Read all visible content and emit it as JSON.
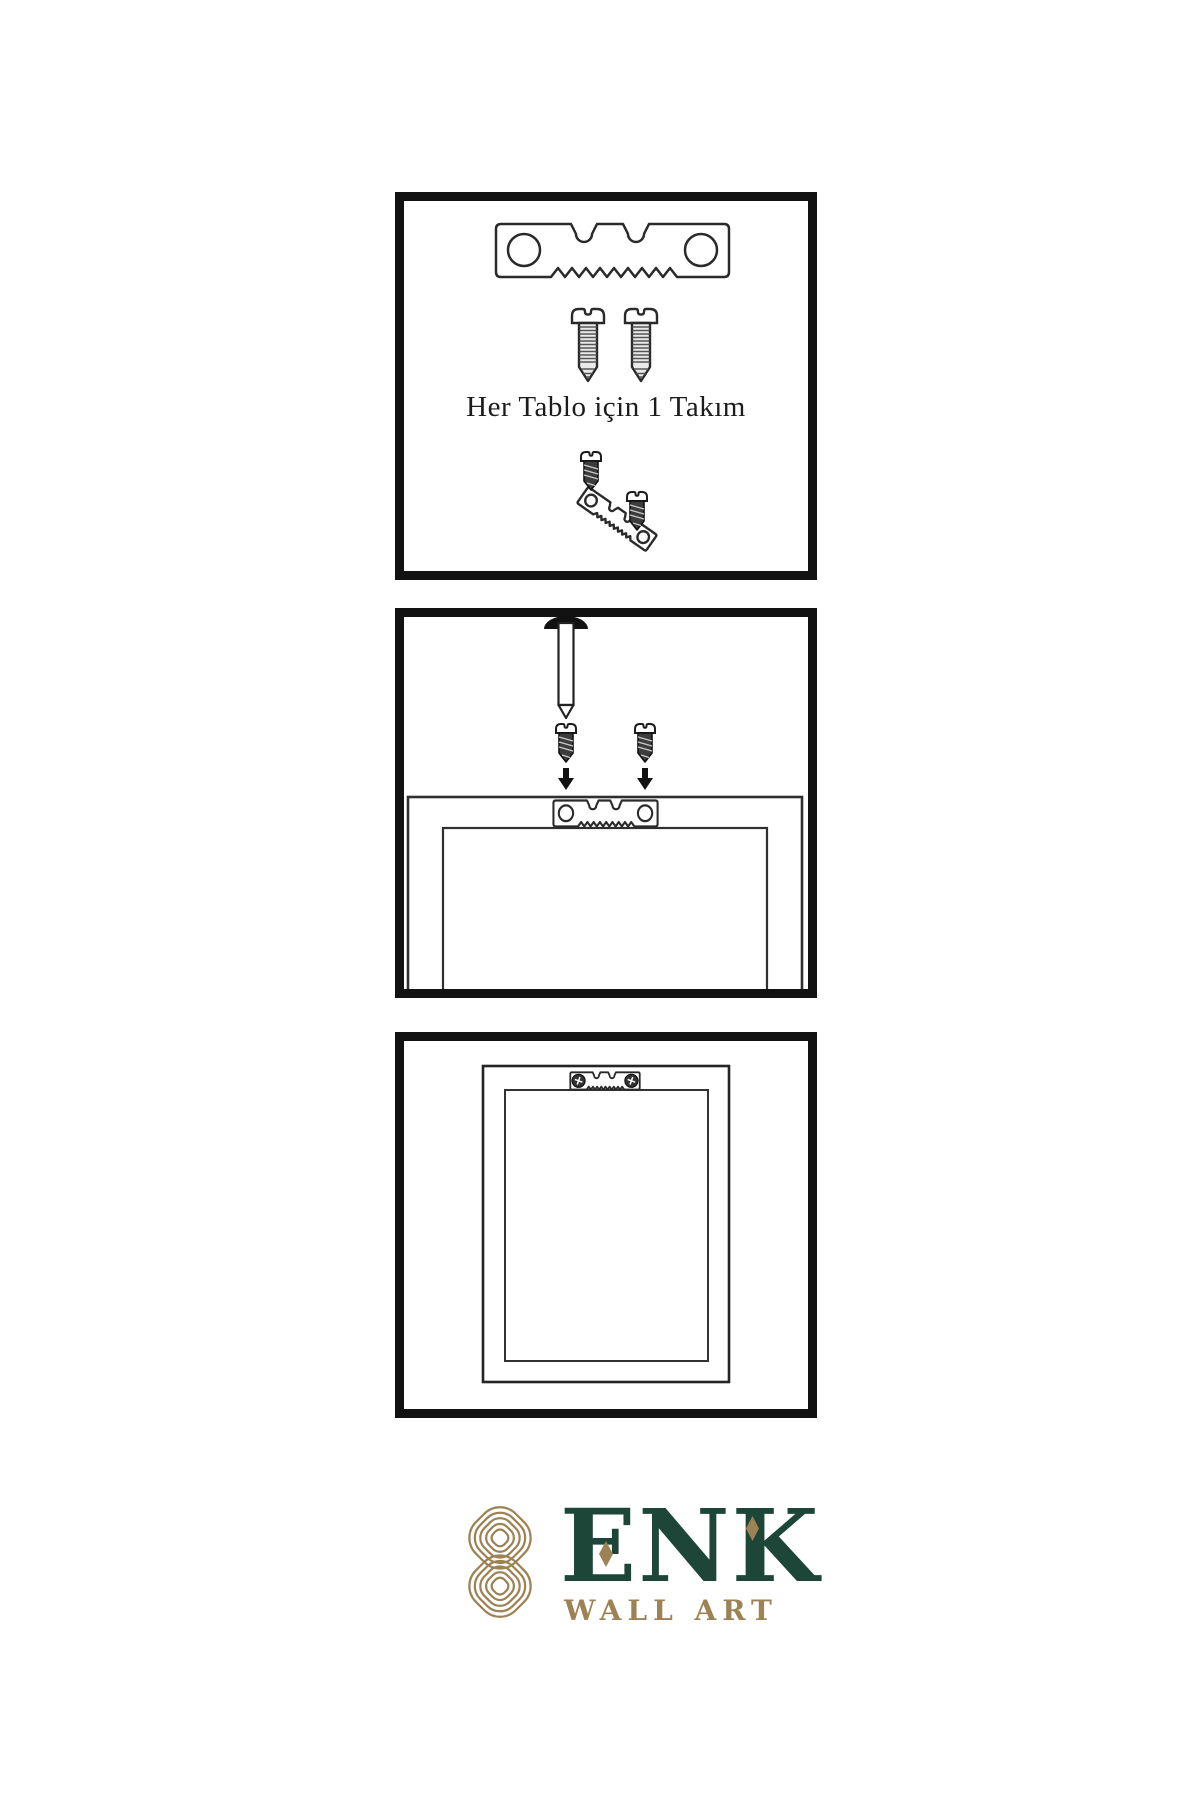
{
  "instructions": {
    "step1": {
      "caption": "Her Tablo için 1 Takım",
      "items": [
        "sawtooth-hanger",
        "mounting-screw",
        "mounting-screw",
        "screw-driven-into-hanger"
      ]
    },
    "step2": {
      "items": [
        "wall-nail",
        "mounting-screw",
        "mounting-screw",
        "down-arrow",
        "down-arrow",
        "frame-back-with-sawtooth-hanger"
      ]
    },
    "step3": {
      "items": [
        "hung-frame-back-with-installed-hanger"
      ]
    }
  },
  "logo": {
    "brand": "ENK",
    "subtitle": "WALL ART"
  },
  "colors": {
    "background": "#ffffff",
    "panel_border": "#121212",
    "line_ink": "#2a2a2a",
    "screw_dark": "#3c3c3c",
    "brand_green": "#1d4639",
    "brand_gold": "#9c8254"
  }
}
